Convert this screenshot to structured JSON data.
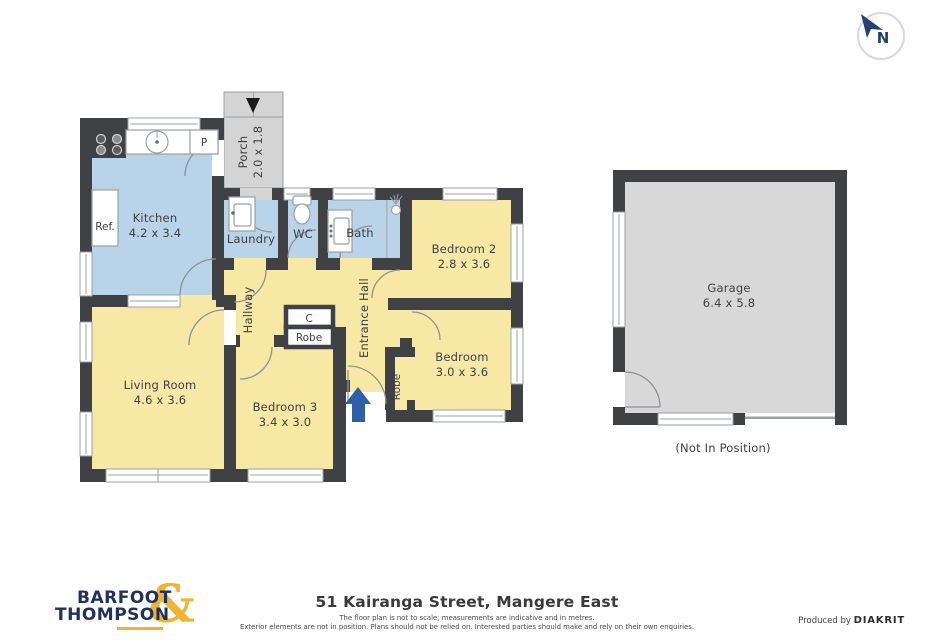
{
  "plan": {
    "compass": {
      "label": "N"
    },
    "rooms": {
      "kitchen": {
        "name": "Kitchen",
        "dims": "4.2 x 3.4"
      },
      "porch": {
        "name": "Porch",
        "dims": "2.0 x 1.8"
      },
      "laundry": {
        "name": "Laundry"
      },
      "wc": {
        "name": "WC"
      },
      "bath": {
        "name": "Bath"
      },
      "bedroom2": {
        "name": "Bedroom 2",
        "dims": "2.8 x 3.6"
      },
      "bedroom": {
        "name": "Bedroom",
        "dims": "3.0 x 3.6"
      },
      "bedroom3": {
        "name": "Bedroom 3",
        "dims": "3.4 x 3.0"
      },
      "living": {
        "name": "Living Room",
        "dims": "4.6 x 3.6"
      },
      "hallway": {
        "name": "Hallway"
      },
      "entrance_hall": {
        "name": "Entrance Hall"
      },
      "cupboard": {
        "label": "C"
      },
      "robe_hall": {
        "label": "Robe"
      },
      "robe_bedroom": {
        "label": "Robe"
      },
      "garage": {
        "name": "Garage",
        "dims": "6.4 x 5.8",
        "note": "(Not In Position)"
      }
    },
    "fixtures": {
      "fridge": "Ref.",
      "pantry": "P"
    }
  },
  "footer": {
    "brand": {
      "line1": "BARFOOT",
      "line2": "THOMPSON",
      "ampersand": "&"
    },
    "address": "51 Kairanga Street, Mangere East",
    "disclaimer1": "The floor plan is not to scale; measurements are indicative and in metres.",
    "disclaimer2": "Exterior elements are not in position. Plans should not be relied on. Interested parties should make and rely on their own enquiries.",
    "produced_by": "Produced by",
    "producer": "DIAKRIT"
  },
  "colors": {
    "wall": "#3f4144",
    "wet_room_fill": "#b9d3e8",
    "living_area_fill": "#f8e8a6",
    "exterior_fill": "#d4d4d4",
    "garage_fill": "#d8d8d8",
    "entry_arrow": "#2f5fa7",
    "brand_navy": "#20305f",
    "brand_gold": "#efb532"
  }
}
